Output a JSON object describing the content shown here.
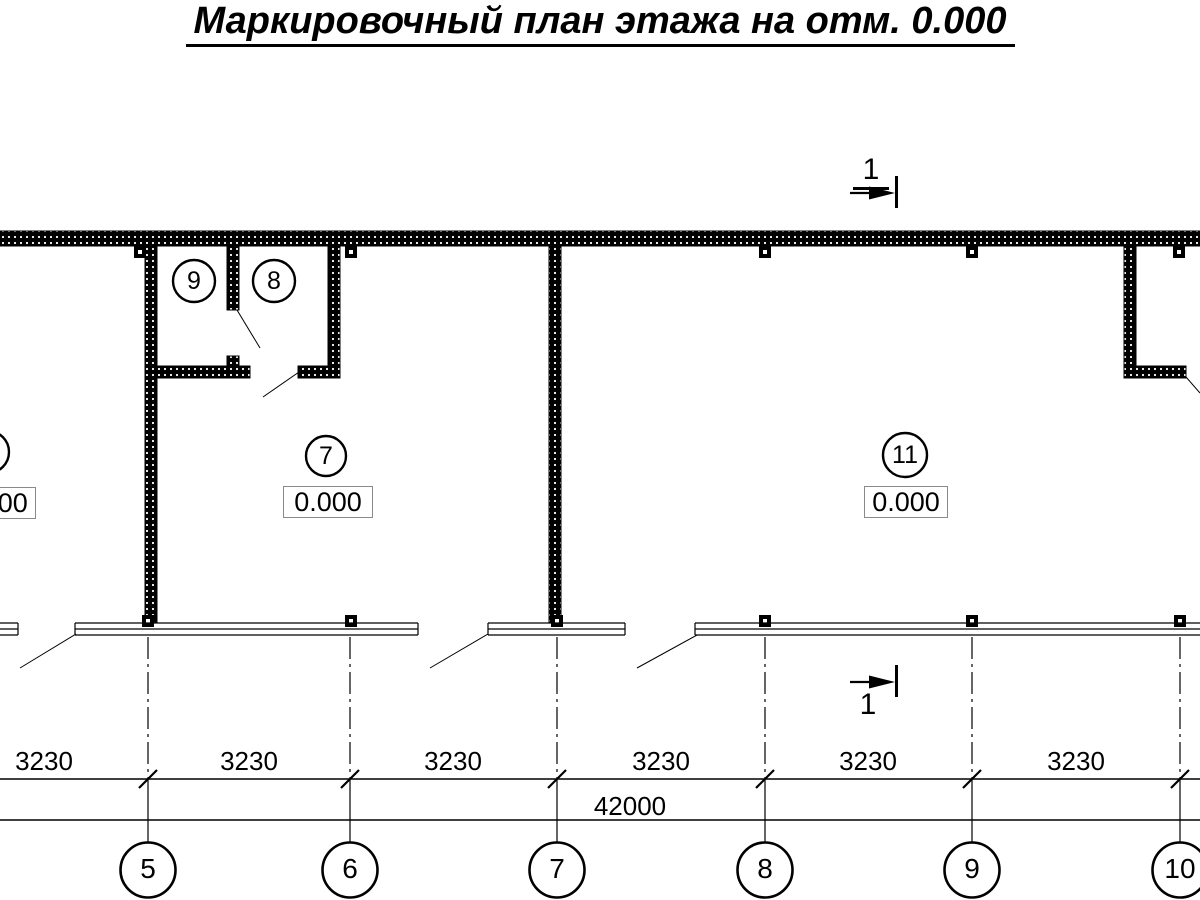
{
  "title": "Маркировочный план этажа на отм. 0.000",
  "section_mark": {
    "label": "1"
  },
  "room_tags": {
    "room9": "9",
    "room8": "8",
    "room7": "7",
    "room11": "11",
    "elevation7": "0.000",
    "elevation11": "0.000",
    "elevation_left_partial": "0.000"
  },
  "dimensions": {
    "segments": [
      "3230",
      "3230",
      "3230",
      "3230",
      "3230",
      "3230"
    ],
    "total": "42000"
  },
  "axes": [
    "5",
    "6",
    "7",
    "8",
    "9",
    "10"
  ],
  "colors": {
    "line": "#000000",
    "background": "#ffffff",
    "elevation_box_border": "#8a8a8a"
  }
}
